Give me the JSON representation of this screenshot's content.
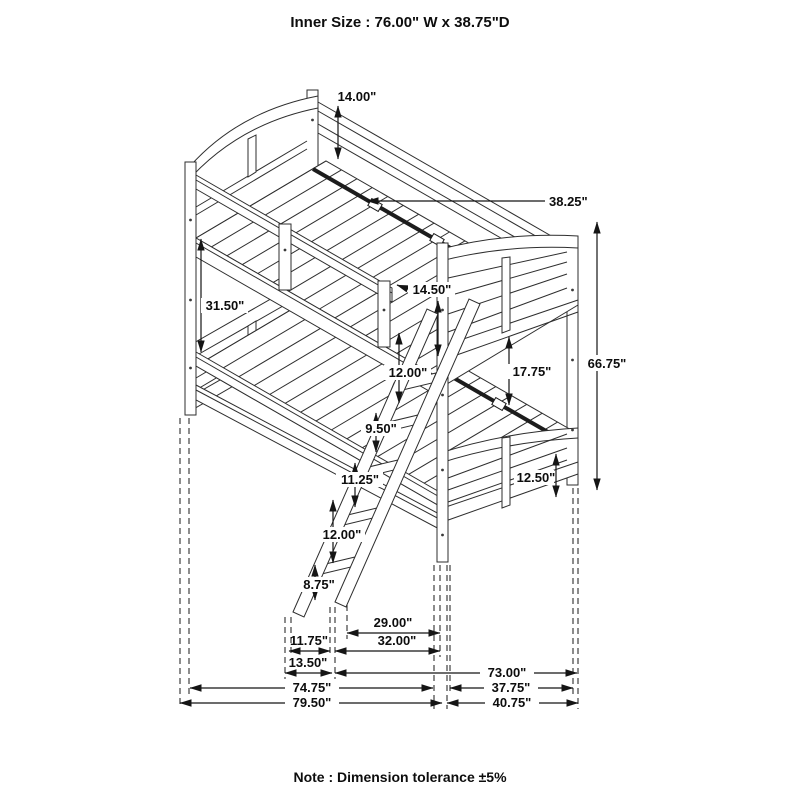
{
  "title": "Inner Size : 76.00\" W x 38.75\"D",
  "note": "Note : Dimension tolerance ±5%",
  "dims": {
    "back_rail_height": "14.00\"",
    "deck_depth": "38.25\"",
    "bunk_gap": "31.50\"",
    "guard_rail_height": "14.50\"",
    "overall_height": "66.75\"",
    "mattress_clearance": "17.75\"",
    "ladder_step_1": "12.00\"",
    "ladder_step_2": "9.50\"",
    "ladder_step_3": "11.25\"",
    "ladder_step_4": "12.00\"",
    "ladder_step_5": "8.75\"",
    "floor_clearance": "12.50\"",
    "ladder_clear_inner": "29.00\"",
    "ladder_clear_outer": "32.00\"",
    "ladder_depth_inner": "11.75\"",
    "ladder_depth_outer": "13.50\"",
    "length_ladder_to_back": "73.00\"",
    "length_inner": "74.75\"",
    "depth_inner": "37.75\"",
    "overall_length": "79.50\"",
    "overall_depth": "40.75\""
  }
}
